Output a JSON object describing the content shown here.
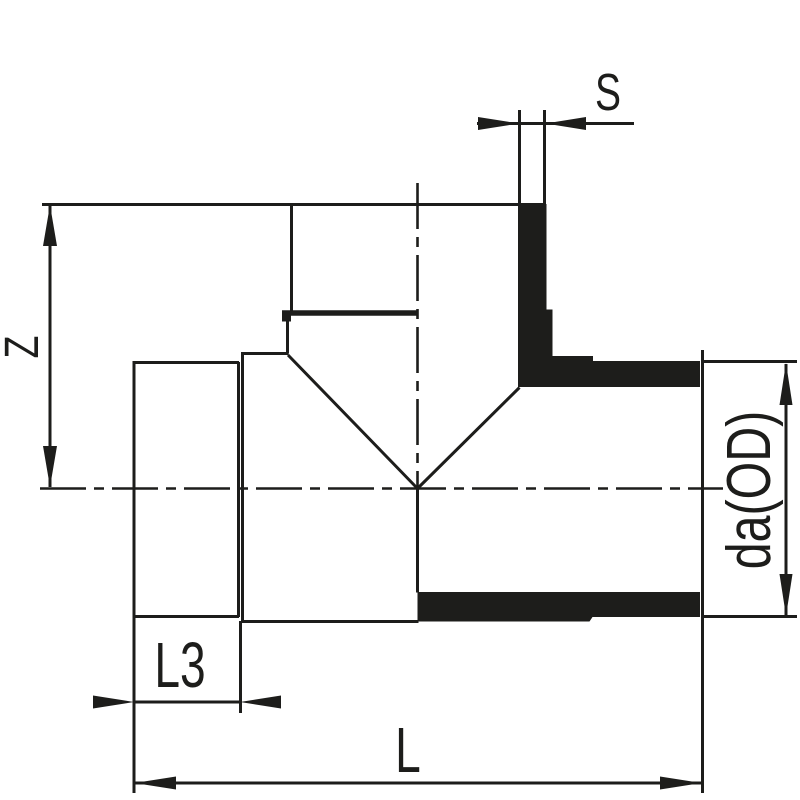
{
  "drawing": {
    "background_color": "#ffffff",
    "line_color": "#1d1d1b",
    "labels": {
      "s": "S",
      "z": "Z",
      "l3": "L3",
      "l": "L",
      "da": "da(OD)"
    }
  }
}
